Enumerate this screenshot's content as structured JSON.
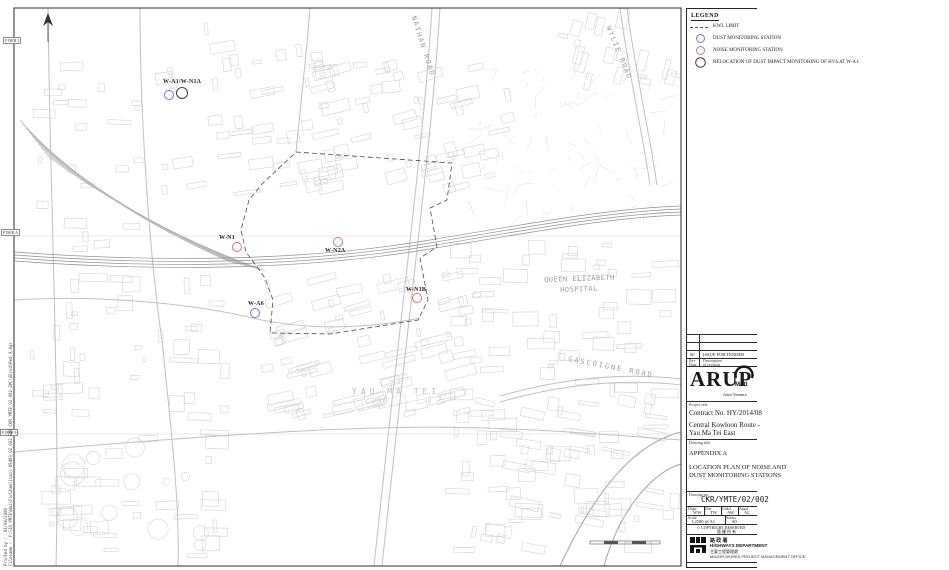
{
  "colors": {
    "dust": "#7575c6",
    "noise": "#c87878",
    "relocation": "#3d3d4d",
    "limit": "#4a4a55"
  },
  "legend": {
    "title": "LEGEND",
    "items": [
      {
        "type": "dash",
        "label": "KWL LIMIT",
        "color": "#555555"
      },
      {
        "type": "circle",
        "label": "DUST MONITORING STATION",
        "color": "#7575c6"
      },
      {
        "type": "circle",
        "label": "NOISE MONITORING STATION",
        "color": "#c87878"
      },
      {
        "type": "circle",
        "label": "RELOCATION OF DUST IMPACT MONITORING OF HVS AT W-A1",
        "color": "#3d3d4d"
      }
    ]
  },
  "map": {
    "stations": [
      {
        "label": "W-A1/W-N1A",
        "type": "dust-and-relocation"
      },
      {
        "label": "W-N1",
        "type": "noise"
      },
      {
        "label": "W-N2A",
        "type": "noise"
      },
      {
        "label": "W-N1B",
        "type": "noise"
      },
      {
        "label": "W-A6",
        "type": "dust"
      }
    ],
    "roads": {
      "nathan": "NATHAN ROAD",
      "wylie": "WYLIE ROAD",
      "gascoigne": "GASCOIGNE ROAD"
    },
    "places": {
      "hospital1": "QUEEN ELIZABETH",
      "hospital2": "HOSPITAL",
      "district": "YAU MA TEI"
    },
    "grid_refs": [
      "F19EB 1",
      "F19EB A",
      "F19EB 9"
    ]
  },
  "titleblock": {
    "revision": {
      "no": "00",
      "description": "ISSUE FOR TENDER",
      "rev_label": "Rev",
      "date_label": "Date",
      "desc_label": "Description",
      "desc_label2": "of revision"
    },
    "firm": "ARUP",
    "partner": "Mott",
    "joint_venture": "Joint Venture",
    "project_label": "Project title",
    "contract": "Contract No. HY/2014/08",
    "project_line1": "Central Kowloon Route -",
    "project_line2": "Yau Ma Tei East",
    "drawing_title_label": "Drawing title",
    "appendix": "APPENDIX A",
    "drawing_title1": "LOCATION PLAN OF NOISE AND",
    "drawing_title2": "DUST MONITORING STATIONS",
    "drawing_no_label": "Drawing no.",
    "drawing_no": "CKR/YMTE/02/002",
    "initials": [
      {
        "label": "Dsgn",
        "value": "WW"
      },
      {
        "label": "Drn",
        "value": "TW"
      },
      {
        "label": "Chkd",
        "value": "AW"
      },
      {
        "label": "Appd",
        "value": "AL"
      }
    ],
    "scale_label": "Scale",
    "scale": "1:2500 @ A1",
    "status_label": "Status",
    "status": "S0",
    "copyright": "© COPYRIGHT RESERVED",
    "copyright_cn": "版 權 所 有",
    "dept_cn": "路 政 署",
    "dept_en": "HIGHWAYS DEPARTMENT",
    "division_cn": "主要工程管理處",
    "division_en": "MAJOR WORKS PROJECT MANAGEMENT OFFICE"
  },
  "edge": {
    "printed_label": "Printed by :",
    "printed_value": "03/04/2008",
    "file_label": "Filename :",
    "file_value": "F:\\10_YMTE\\Wai\\ForGham\\(can)-89403_02_002-E#0-CKR_YMTE_02_002-2#C\\OErsd\\Red_A.kgr"
  }
}
